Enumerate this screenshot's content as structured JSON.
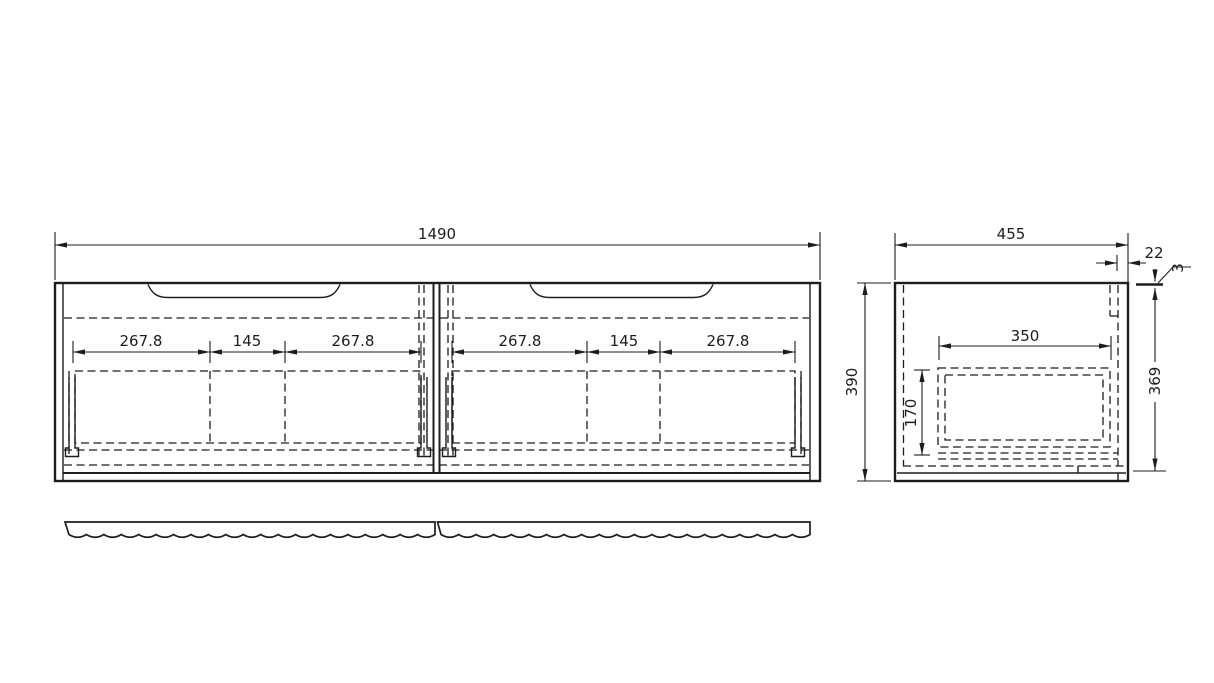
{
  "front_view": {
    "overall_width_mm": "1490",
    "left_door_segments": [
      "267.8",
      "145",
      "267.8"
    ],
    "right_door_segments": [
      "267.8",
      "145",
      "267.8"
    ]
  },
  "side_view": {
    "depth_mm": "455",
    "back_rail_offset_mm": "22",
    "top_gap_mm": "3",
    "overall_height_mm": "390",
    "inner_height_mm": "369",
    "drawer_depth_mm": "350",
    "drawer_inner_height_mm": "170"
  },
  "colors": {
    "line": "#1d1d1d",
    "background": "#ffffff"
  }
}
